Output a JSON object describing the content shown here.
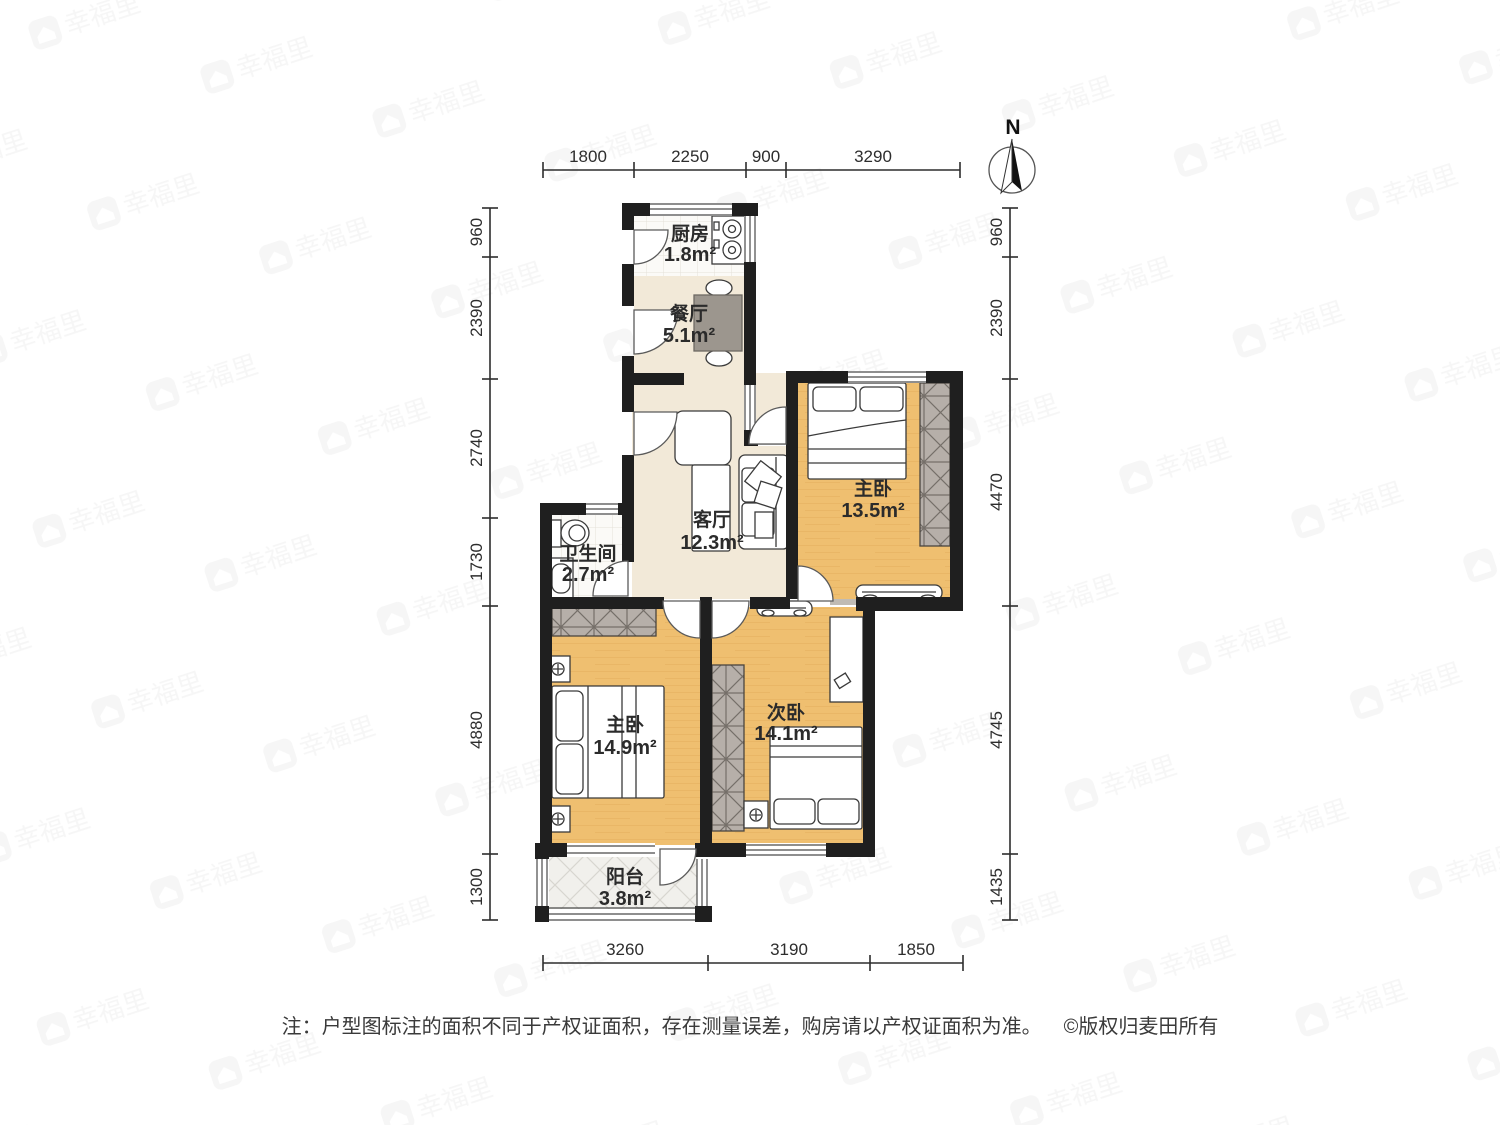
{
  "title": "户型图",
  "compass": {
    "label": "N"
  },
  "watermark": {
    "icon": "house-logo-icon",
    "text": "幸福里"
  },
  "rooms": [
    {
      "id": "kitchen",
      "name": "厨房",
      "area": "1.8m²"
    },
    {
      "id": "dining",
      "name": "餐厅",
      "area": "5.1m²"
    },
    {
      "id": "living",
      "name": "客厅",
      "area": "12.3m²"
    },
    {
      "id": "bathroom",
      "name": "卫生间",
      "area": "2.7m²"
    },
    {
      "id": "master-top",
      "name": "主卧",
      "area": "13.5m²"
    },
    {
      "id": "master-low",
      "name": "主卧",
      "area": "14.9m²"
    },
    {
      "id": "second",
      "name": "次卧",
      "area": "14.1m²"
    },
    {
      "id": "balcony",
      "name": "阳台",
      "area": "3.8m²"
    }
  ],
  "dims": {
    "top": [
      "1800",
      "2250",
      "900",
      "3290"
    ],
    "left": [
      "960",
      "2390",
      "2740",
      "1730",
      "4880",
      "1300"
    ],
    "right": [
      "960",
      "2390",
      "4470",
      "4745",
      "1435"
    ],
    "bottom": [
      "3260",
      "3190",
      "1850"
    ]
  },
  "footer": {
    "note": "注：户型图标注的面积不同于产权证面积，存在测量误差，购房请以产权证面积为准。",
    "copyright": "©版权归麦田所有"
  },
  "colors": {
    "wall": "#1f1f1f",
    "bedroom_floor": "#efbf70",
    "public_floor": "#f2e9d8",
    "tile_floor": "#fbfaf7",
    "wardrobe": "#b6afa9",
    "dining_table": "#9c968e"
  }
}
